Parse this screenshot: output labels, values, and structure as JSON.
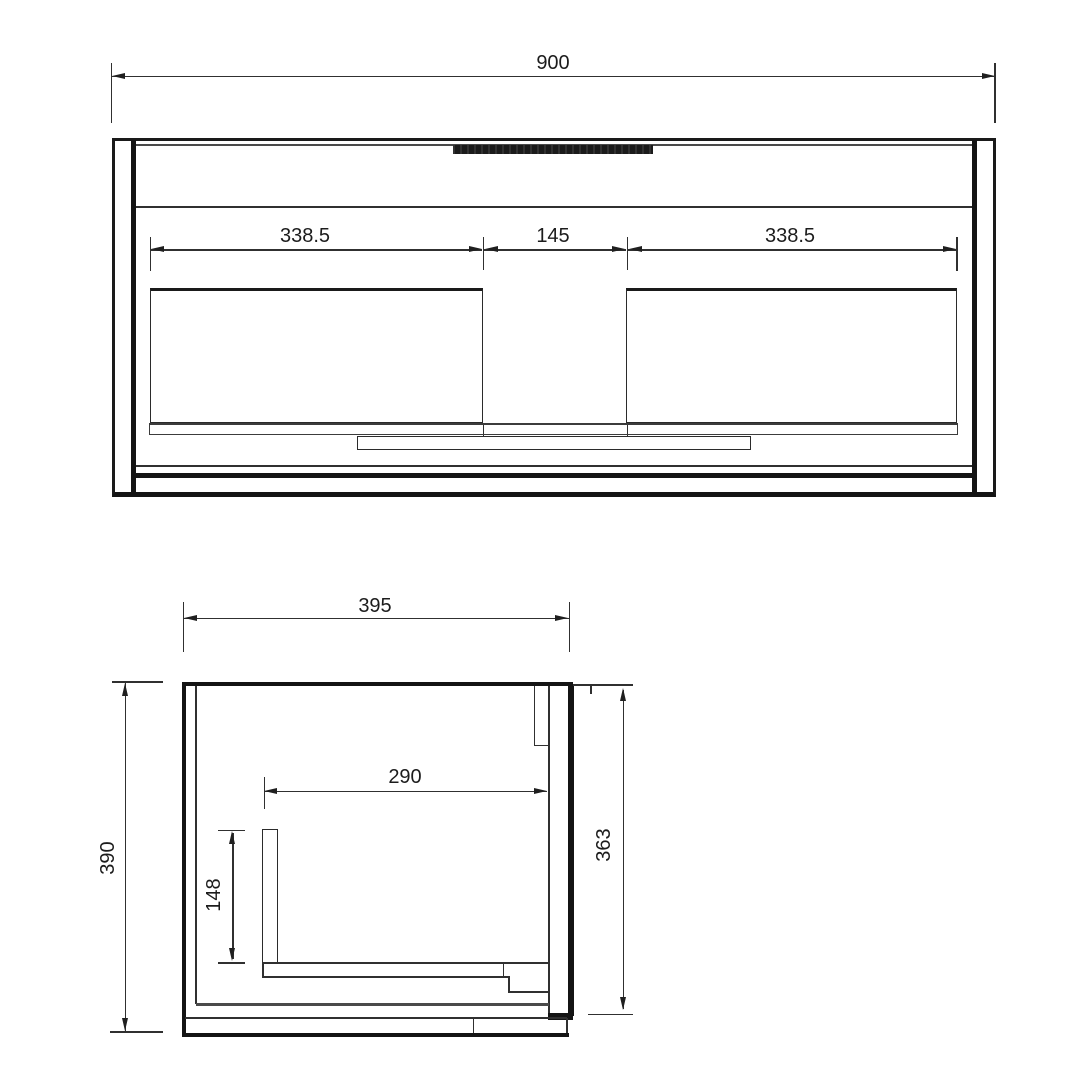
{
  "drawing": {
    "front_view": {
      "dim_overall_width": "900",
      "dim_left_drawer": "338.5",
      "dim_center_gap": "145",
      "dim_right_drawer": "338.5"
    },
    "side_view": {
      "dim_depth": "395",
      "dim_height": "390",
      "dim_inner_depth": "290",
      "dim_partition_height": "148",
      "dim_back_height": "363"
    },
    "colors": {
      "line": "#303030",
      "thick_line": "#141414",
      "background": "#ffffff",
      "handle_strip": "#1b1b1b",
      "label_text": "#1c1c1c"
    }
  }
}
